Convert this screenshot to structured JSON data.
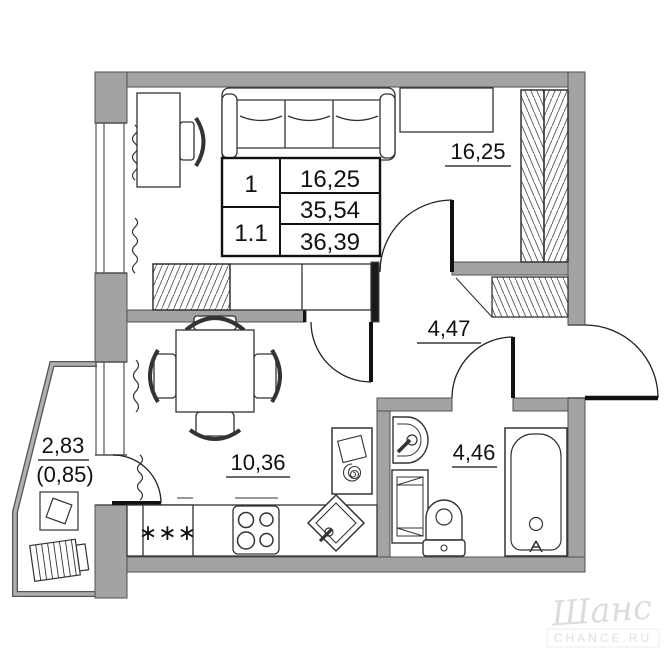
{
  "plan": {
    "info_table": {
      "unit_rooms": "1",
      "unit_number": "1.1",
      "areas": [
        "16,25",
        "35,54",
        "36,39"
      ]
    },
    "rooms": {
      "living_room": {
        "area_label": "16,25"
      },
      "hallway": {
        "area_label": "4,47"
      },
      "kitchen": {
        "area_label": "10,36",
        "freezer_rating": "∗∗∗"
      },
      "bathroom": {
        "area_label": "4,46"
      },
      "balcony": {
        "area_label": "2,83",
        "area_reduced_label": "(0,85)"
      }
    },
    "watermark": {
      "brand_script": "Шанс",
      "brand_caption": "CHANCE.RU"
    }
  }
}
